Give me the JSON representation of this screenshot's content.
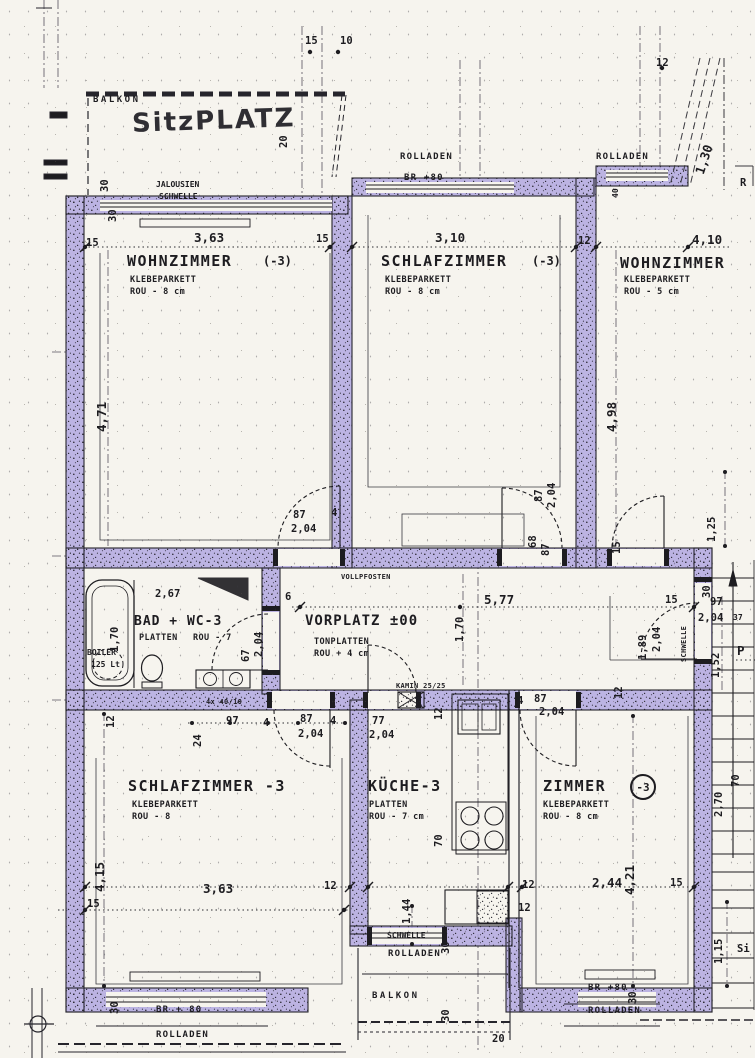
{
  "colors": {
    "wall_highlight": "#b2a8e0",
    "ink": "#1d1c20",
    "paper": "#f6f4ee"
  },
  "texts": {
    "balkon_top": "BALKON",
    "sitzplatz": "SitzPLATZ",
    "d20_sp": "20",
    "d15_top": "15",
    "d10_top": "10",
    "jalousien": "JALOUSIEN",
    "schwelle_top": "SCHWELLE",
    "d30_t1": "30",
    "d30_t2": "30",
    "rolladen_t1": "ROLLADEN",
    "br80_t1": "BR +80",
    "rolladen_t2": "ROLLADEN",
    "d40_t": "40",
    "d12_tr": "12",
    "d1_30": "1,30",
    "r_edge": "R",
    "d15_w1a": "15",
    "d3_63_w1": "3,63",
    "d15_w1b": "15",
    "wz1_name": "WOHNZIMMER",
    "wz1_tag": "(-3)",
    "wz1_mat": "KLEBEPARKETT",
    "wz1_sub": "ROU - 8 cm",
    "d3_10": "3,10",
    "d12_sz": "12",
    "sz1_name": "SCHLAFZIMMER",
    "sz1_tag": "(-3)",
    "sz1_mat": "KLEBEPARKETT",
    "sz1_sub": "ROU - 8 cm",
    "d4_10": "4,10",
    "wz2_name": "WOHNZIMMER",
    "wz2_mat": "KLEBEPARKETT",
    "wz2_sub": "ROU - 5 cm",
    "d4_71": "4,71",
    "d4_98": "4,98",
    "d87_a": "87",
    "d2_04_a": "2,04",
    "d4_a": "4",
    "d87_b": "87",
    "d2_04_b": "2,04",
    "d68": "68",
    "d87_c": "87",
    "d1_25": "1,25",
    "d15_mid": "15",
    "vollpfosten": "VOLLPFOSTEN",
    "d2_67": "2,67",
    "badwc_name": "BAD + WC-3",
    "bad_mat": "PLATTEN",
    "bad_sub": "ROU - 7",
    "d1_70a": "1,70",
    "boiler1": "BOILER",
    "boiler2": "125 Lt",
    "d67": "67",
    "d2_04_c": "2,04",
    "d6": "6",
    "vp_name": "VORPLATZ ±00",
    "vp_mat": "TONPLATTEN",
    "vp_sub": "ROU + 4 cm",
    "d5_77": "5,77",
    "d1_70b": "1,70",
    "d30_mr": "30",
    "d15_mr": "15",
    "d97_mr": "97",
    "d2_04_mr": "2,04",
    "d37_mr": "37",
    "d1_52": "1,52",
    "p_edge": "P",
    "schwelle_vr": "SCHWELLE",
    "d1_89": "1,89",
    "d2_04_d": "2,04",
    "d12_m1": "12",
    "kamin": "KAMIN 25/25",
    "d4x40": "4x 40/10",
    "d24": "24",
    "d97_b": "97",
    "d4_b": "4",
    "d87_d": "87",
    "d2_04_f": "2,04",
    "d4_c": "4",
    "sz2_name": "SCHLAFZIMMER -3",
    "sz2_mat": "KLEBEPARKETT",
    "sz2_sub": "ROU - 8",
    "d4_15": "4,15",
    "d15_b1": "15",
    "d3_63_b": "3,63",
    "d12_b1": "12",
    "d30_b1": "30",
    "br80_b1": "BR + 80",
    "rolladen_b1": "ROLLADEN",
    "d77": "77",
    "d2_04_g": "2,04",
    "d12_k": "12",
    "kueche_name": "KÜCHE-3",
    "k_mat": "PLATTEN",
    "k_sub": "ROU - 7 cm",
    "d70_k": "70",
    "d4_d": "4",
    "d87_e": "87",
    "d2_04_h": "2,04",
    "zimmer_name": "ZIMMER",
    "zimmer_tag": "-3",
    "z_mat": "KLEBEPARKETT",
    "z_sub": "ROU - 8 cm",
    "d4_21": "4,21",
    "d12_b2": "12",
    "d2_44": "2,44",
    "d15_b2": "15",
    "d1_15": "1,15",
    "si_frag": "Si",
    "d30_b2": "30",
    "br80_b2": "BR +80",
    "rolladen_b2": "ROLLADEN",
    "schwelle_b": "SCHWELLE",
    "rolladen_b3": "ROLLADEN",
    "balkon_b": "BALKON",
    "d30_b3": "30",
    "d30_b4": "30",
    "d20_b": "20",
    "d12_b3": "12",
    "d1_44": "1,44",
    "d2_70": "2,70",
    "d70_s": "70",
    "d12_left": "12"
  }
}
